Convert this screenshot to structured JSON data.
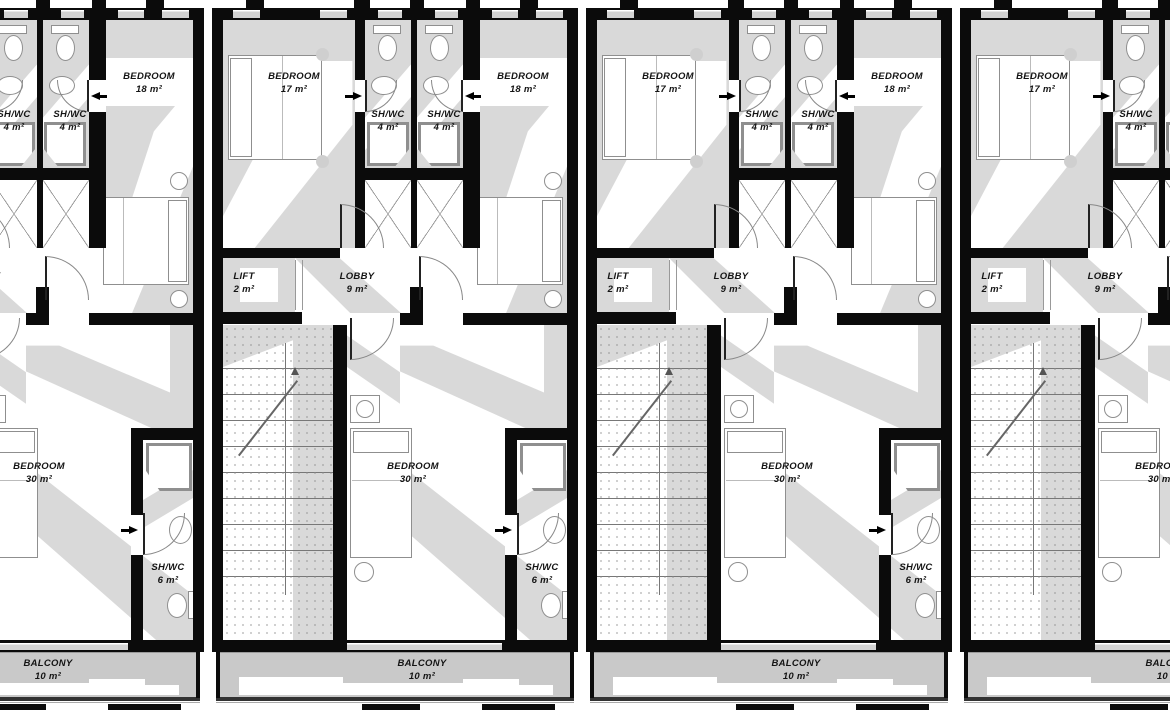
{
  "colors": {
    "wall": "#0b0b0b",
    "shade": "#d9d9d9",
    "line": "#8f8f8f",
    "text": "#141414",
    "balcony": "#c9c9c9",
    "stray": "#4a72c4"
  },
  "rooms": {
    "bedroom17": {
      "name": "BEDROOM",
      "area": "17 m²"
    },
    "bedroom18": {
      "name": "BEDROOM",
      "area": "18 m²"
    },
    "bedroom30": {
      "name": "BEDROOM",
      "area": "30 m²"
    },
    "shwc4": {
      "name": "SH/WC",
      "area": "4 m²"
    },
    "shwc6": {
      "name": "SH/WC",
      "area": "6 m²"
    },
    "lift": {
      "name": "LIFT",
      "area": "2 m²"
    },
    "lobby": {
      "name": "LOBBY",
      "area": "9 m²"
    },
    "balcony": {
      "name": "BALCONY",
      "area": "10 m²"
    }
  },
  "units": [
    {
      "id": "unit-1"
    },
    {
      "id": "unit-2"
    },
    {
      "id": "unit-3"
    },
    {
      "id": "unit-4"
    }
  ]
}
